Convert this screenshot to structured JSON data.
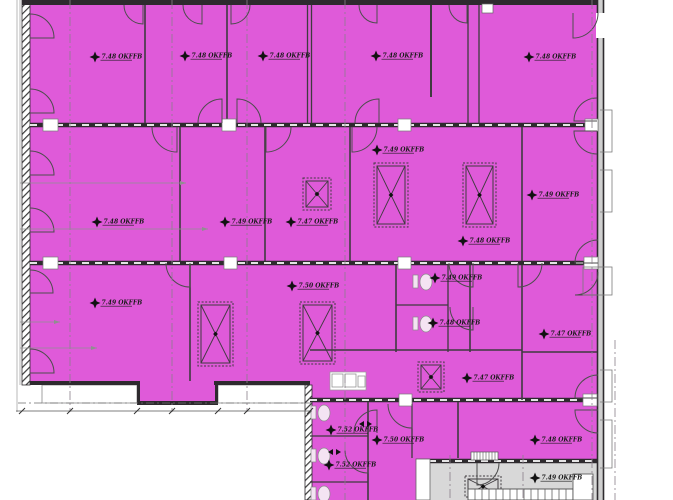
{
  "plan": {
    "type": "architectural-floor-plan",
    "elevation_unit": "OKFFB",
    "colors": {
      "room_fill": "#df5ad9",
      "stair_fill": "#d8d8d8",
      "wall": "#2e2a2e",
      "line": "#4d4d4d",
      "background": "#ffffff"
    },
    "elevation_markers": [
      {
        "x": 95,
        "y": 57,
        "label": "7.48 OKFFB"
      },
      {
        "x": 185,
        "y": 56,
        "label": "7.48 OKFFB"
      },
      {
        "x": 263,
        "y": 56,
        "label": "7.48 OKFFB"
      },
      {
        "x": 376,
        "y": 56,
        "label": "7.48 OKFFB"
      },
      {
        "x": 529,
        "y": 57,
        "label": "7.48 OKFFB"
      },
      {
        "x": 97,
        "y": 222,
        "label": "7.48 OKFFB"
      },
      {
        "x": 225,
        "y": 222,
        "label": "7.49 OKFFB"
      },
      {
        "x": 291,
        "y": 222,
        "label": "7.47 OKFFB"
      },
      {
        "x": 377,
        "y": 150,
        "label": "7.49 OKFFB"
      },
      {
        "x": 532,
        "y": 195,
        "label": "7.49 OKFFB"
      },
      {
        "x": 463,
        "y": 241,
        "label": "7.48 OKFFB"
      },
      {
        "x": 95,
        "y": 303,
        "label": "7.49 OKFFB"
      },
      {
        "x": 292,
        "y": 286,
        "label": "7.50 OKFFB"
      },
      {
        "x": 435,
        "y": 278,
        "label": "7.49 OKFFB"
      },
      {
        "x": 433,
        "y": 323,
        "label": "7.48 OKFFB"
      },
      {
        "x": 544,
        "y": 334,
        "label": "7.47 OKFFB"
      },
      {
        "x": 467,
        "y": 378,
        "label": "7.47 OKFFB"
      },
      {
        "x": 331,
        "y": 430,
        "label": "7.52 OKFFB"
      },
      {
        "x": 377,
        "y": 440,
        "label": "7.50 OKFFB"
      },
      {
        "x": 329,
        "y": 465,
        "label": "7.52 OKFFB"
      },
      {
        "x": 535,
        "y": 440,
        "label": "7.48 OKFFB"
      },
      {
        "x": 535,
        "y": 478,
        "label": "7.49 OKFFB"
      }
    ]
  }
}
